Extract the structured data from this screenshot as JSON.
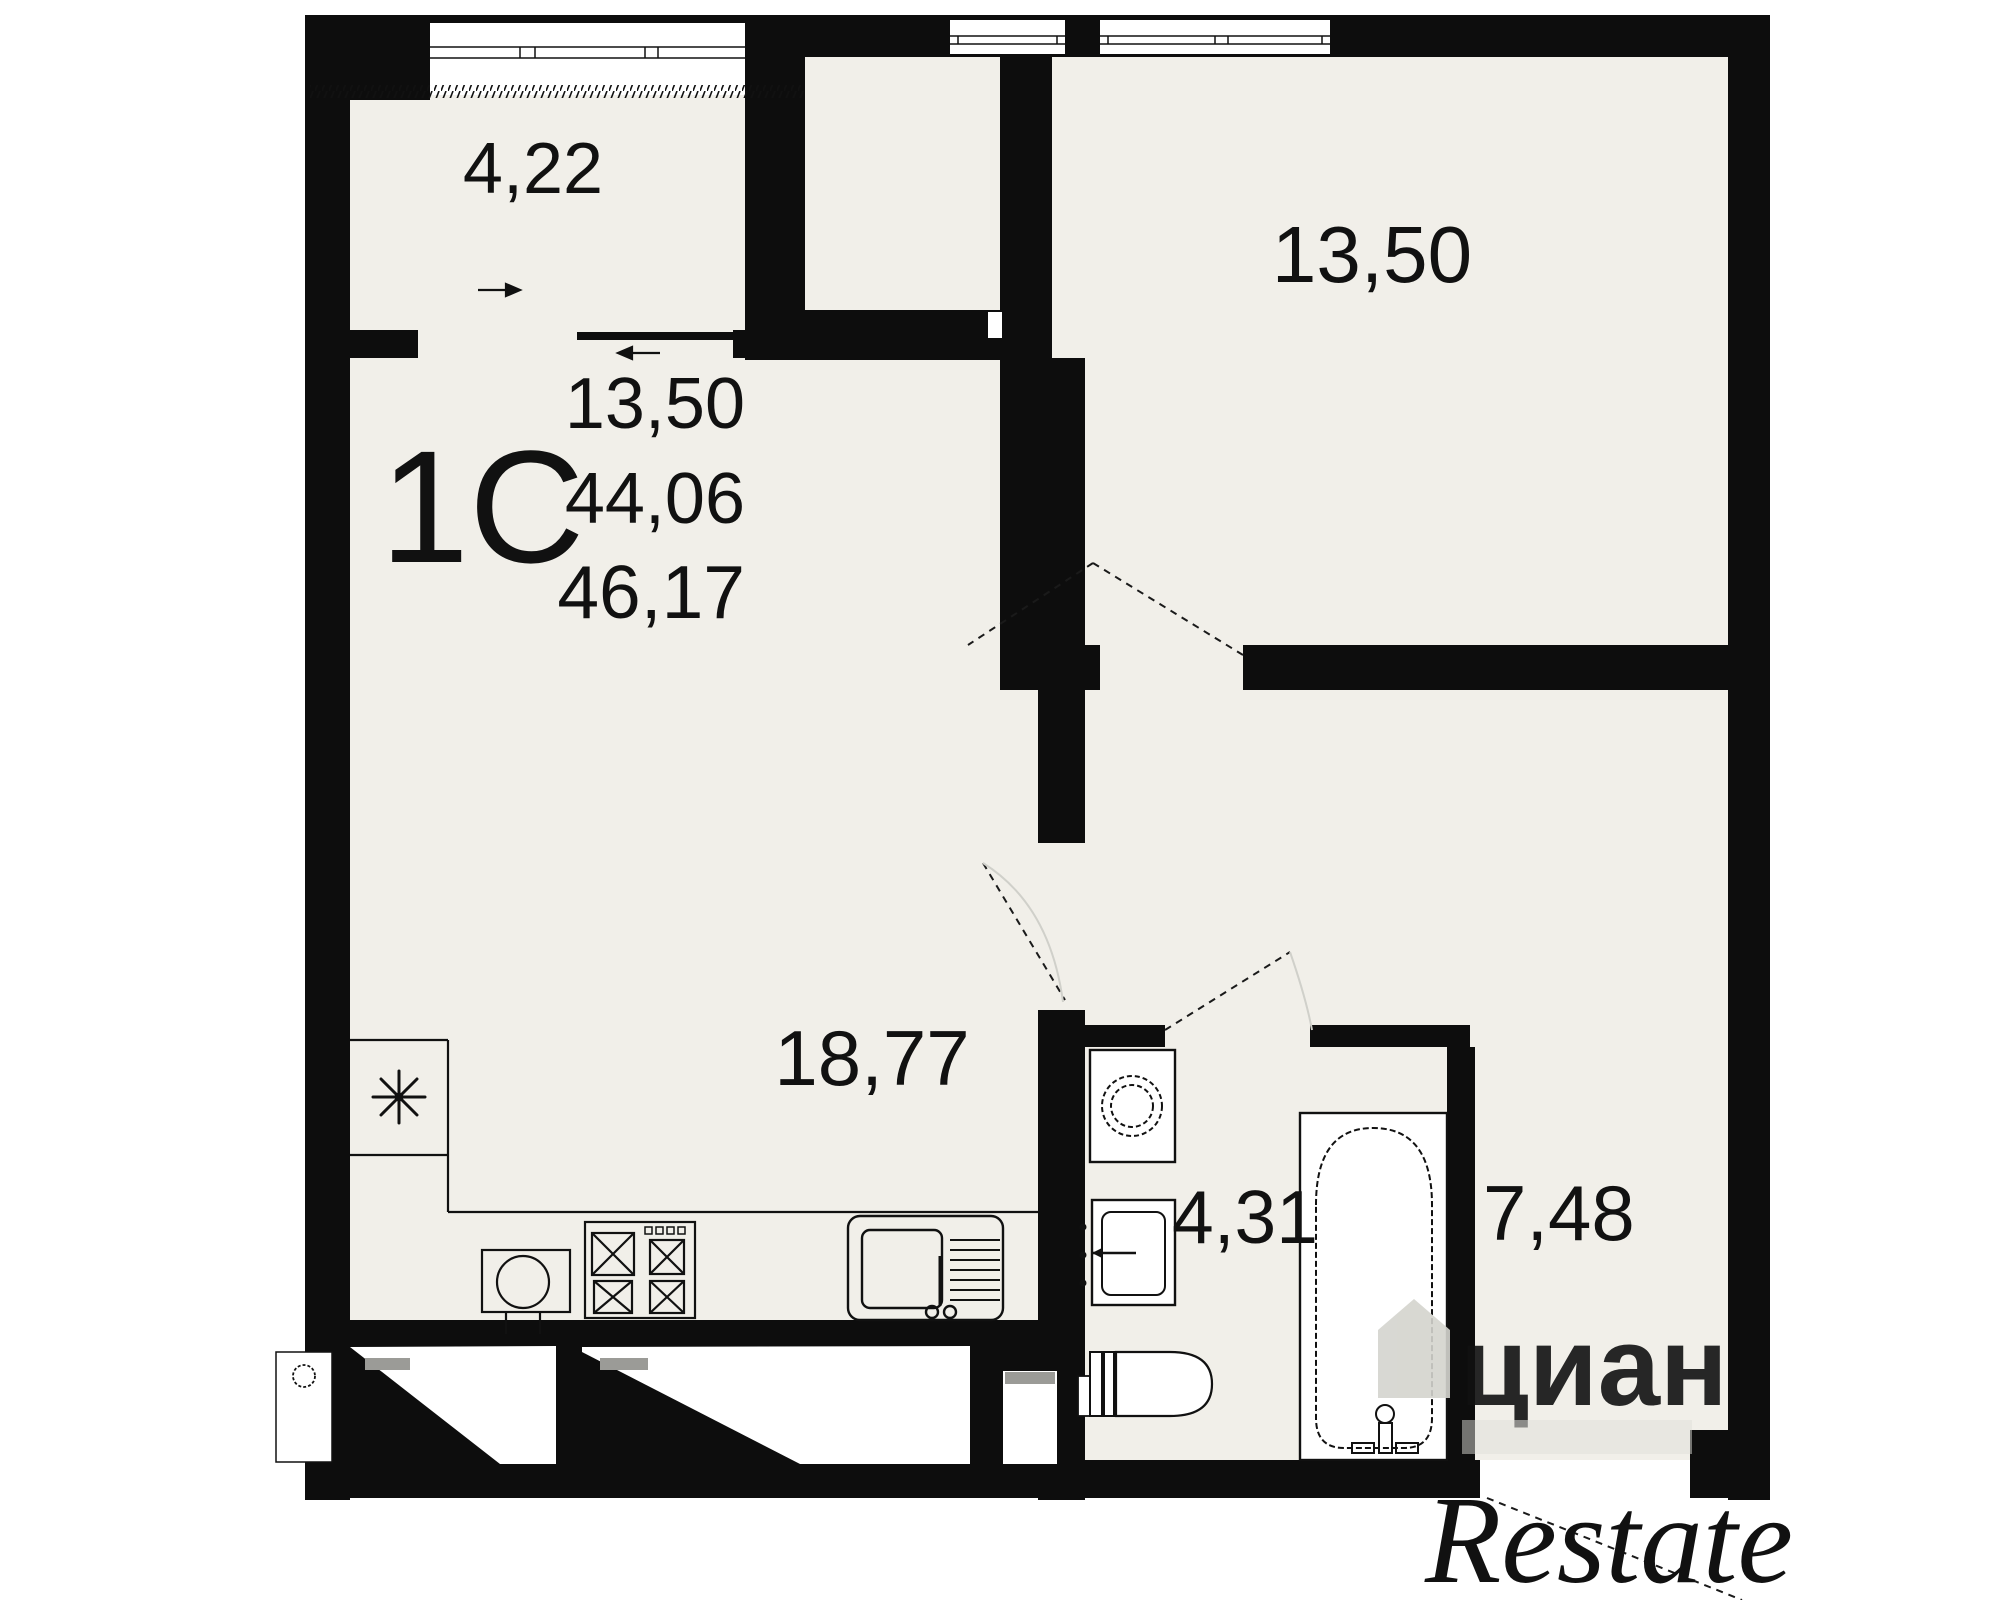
{
  "plan_title": "apartment floor plan",
  "unit": {
    "type_label": "1С",
    "living_area": "13,50",
    "area": "44,06",
    "total_area": "46,17"
  },
  "rooms": [
    {
      "id": "balcony",
      "area": "4,22"
    },
    {
      "id": "bedroom",
      "area": "13,50"
    },
    {
      "id": "living-kitchen",
      "area": "18,77"
    },
    {
      "id": "bathroom",
      "area": "4,31"
    },
    {
      "id": "hallway",
      "area": "7,48"
    }
  ],
  "fixtures": [
    "kitchen-sink",
    "stove-4-burner",
    "sink-with-drainboard",
    "washing-machine",
    "washbasin",
    "toilet",
    "bathtub",
    "asterisk-niche"
  ],
  "watermarks": {
    "logo": "циан",
    "agency": "Restate"
  },
  "colors": {
    "wall": "#0d0d0d",
    "floor": "#f1efe9",
    "fixture_fill": "#ffffff",
    "vent_gray": "#9b9b97",
    "watermark_logo": "#d4d4ce",
    "watermark_agency": "#ababa7"
  }
}
